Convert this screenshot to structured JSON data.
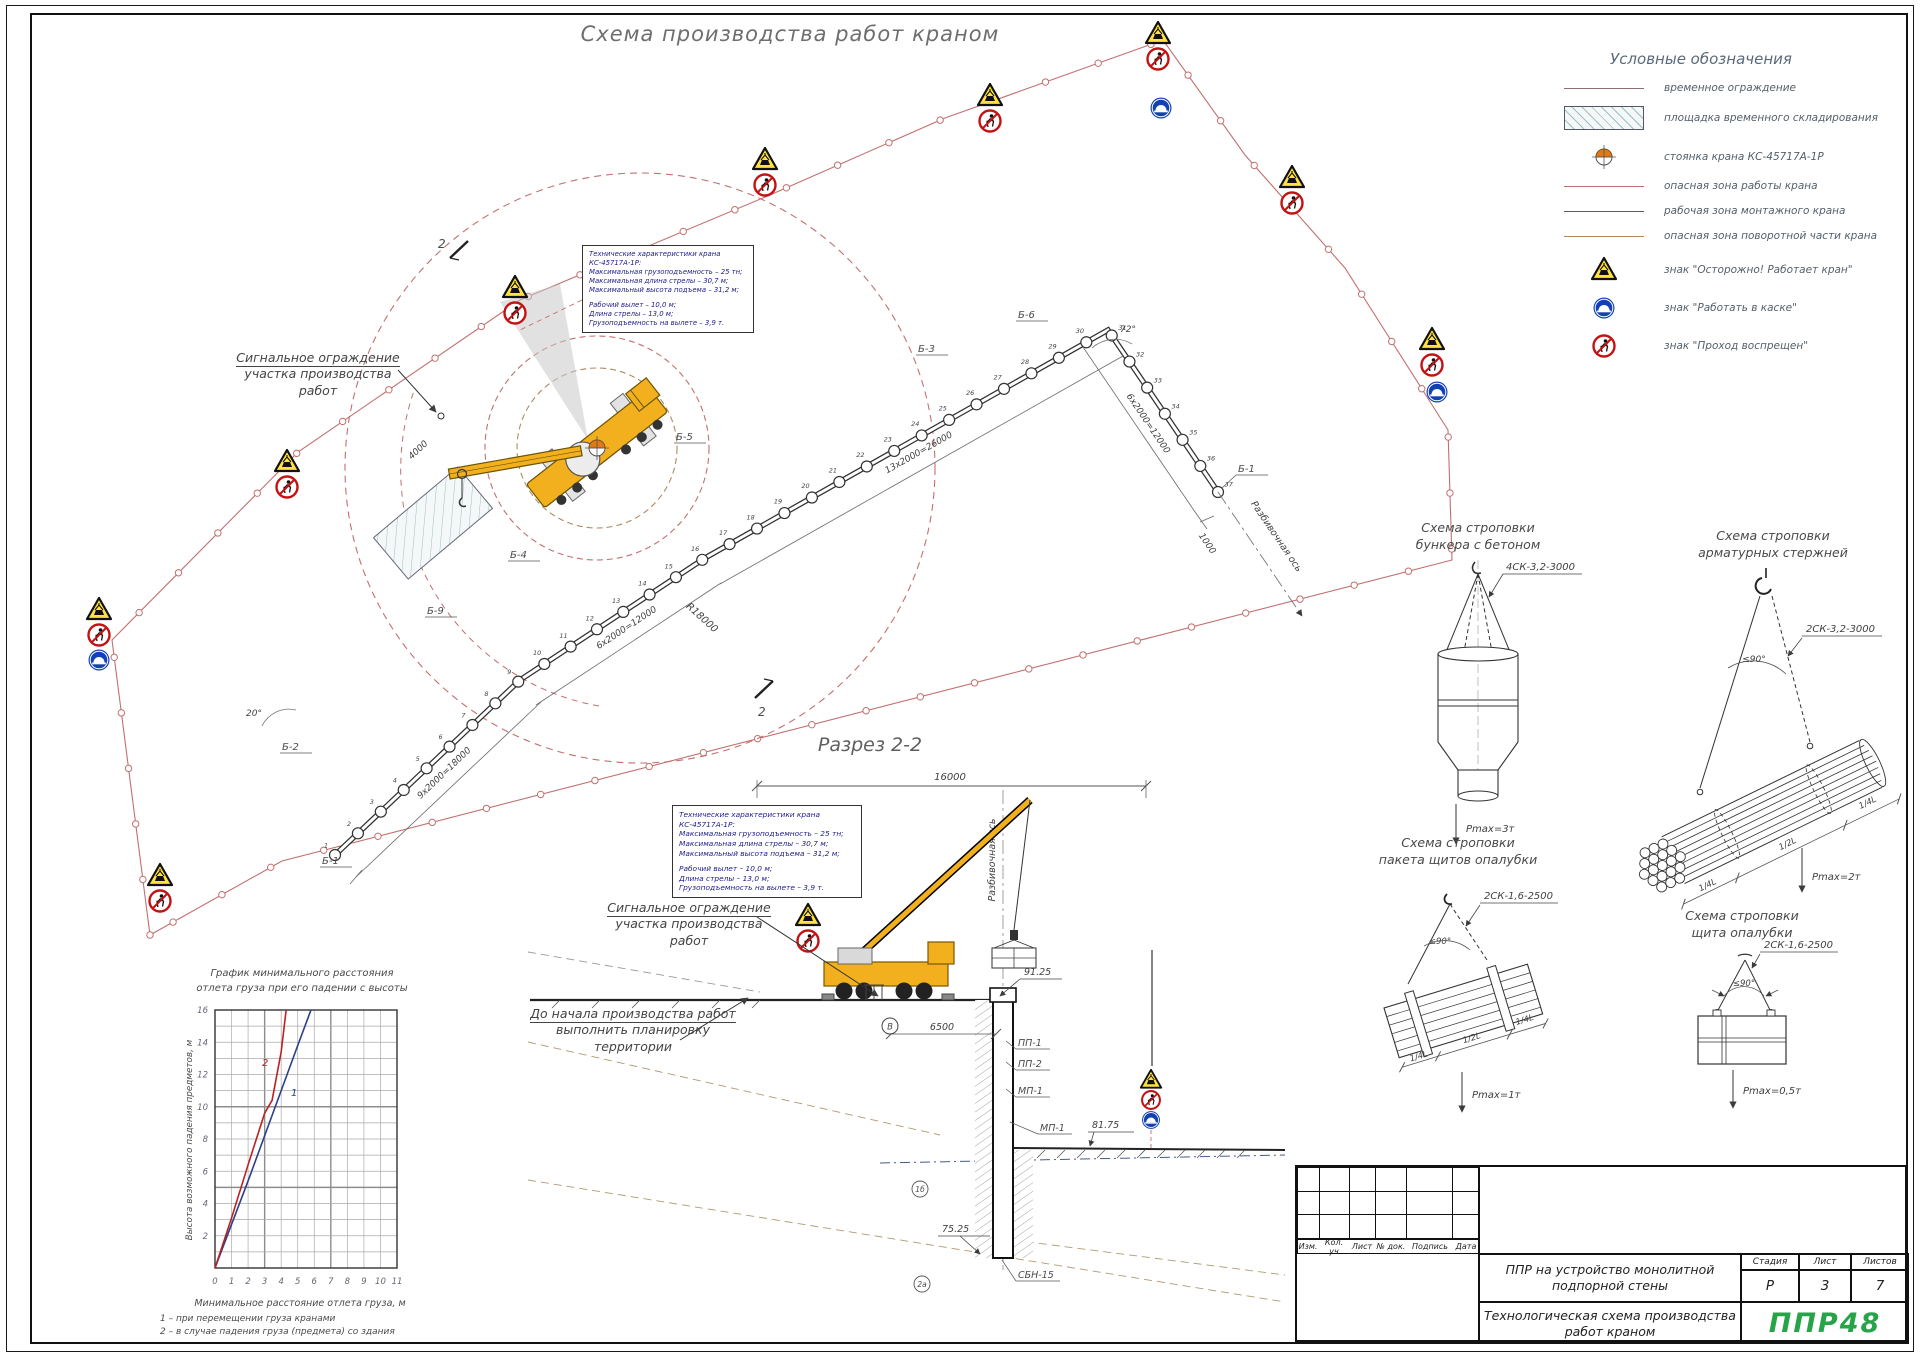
{
  "sheet": {
    "title": "Схема производства работ краном"
  },
  "legend": {
    "title": "Условные обозначения",
    "items": [
      {
        "icon": "line-plain",
        "label": "временное ограждение"
      },
      {
        "icon": "hatch-rect",
        "label": "площадка временного складирования"
      },
      {
        "icon": "crane-parking",
        "label": "стоянка крана КС-45717А-1Р"
      },
      {
        "icon": "line-red",
        "label": "опасная зона работы крана"
      },
      {
        "icon": "line-dark",
        "label": "рабочая зона монтажного крана"
      },
      {
        "icon": "line-brown",
        "label": "опасная зона поворотной части крана"
      },
      {
        "icon": "sign-warning",
        "label": "знак \"Осторожно! Работает кран\""
      },
      {
        "icon": "sign-helmet",
        "label": "знак \"Работать в каске\""
      },
      {
        "icon": "sign-no-entry",
        "label": "знак \"Проход воспрещен\""
      }
    ]
  },
  "crane_specs": {
    "title": "Технические характеристики крана КС-45717А-1Р:",
    "lines1": [
      "Максимальная грузоподъемность – 25 тн;",
      "Максимальная длина стрелы – 30,7 м;",
      "Максимальный высота подъема – 31,2 м;"
    ],
    "lines2": [
      "Рабочий вылет – 10,0 м;",
      "Длина стрелы – 13,0 м;",
      "Грузоподъемность на вылете – 3,9 т."
    ]
  },
  "plan": {
    "callout1": "Сигнальное ограждение",
    "callout2": "участка производства работ",
    "dim_top": "13х2000=26000",
    "dim_mid": "6х2000=12000",
    "dim_low": "9х2000=18000",
    "dim_right": "6х2000=12000",
    "dim_1000": "1000",
    "dim_4000": "4000",
    "radius_label": "R18000",
    "angle_left": "20°",
    "angle_right": "72°",
    "axis_label": "Разбивочная ось",
    "cut_label": "2",
    "marks": {
      "b1": "Б-1",
      "b2": "Б-2",
      "b3": "Б-3",
      "b4": "Б-4",
      "b5": "Б-5",
      "b6": "Б-6",
      "b9": "Б-9",
      "b1r": "Б-1"
    },
    "pile_count": 37
  },
  "section": {
    "title": "Разрез 2-2",
    "callout1": "Сигнальное ограждение",
    "callout2": "участка производства работ",
    "note1": "До начала производства работ",
    "note2": "выполнить планировку территории",
    "axis_label": "Разбивочная ось",
    "dim_width": "16000",
    "dim_offset": "6500",
    "elev_top": "91.25",
    "elev_mid": "81.75",
    "elev_low": "75.25",
    "lbl_pp1": "ПП-1",
    "lbl_pp2": "ПП-2",
    "lbl_mp1": "МП-1",
    "lbl_mp1b": "МП-1",
    "lbl_pile": "СБН-15",
    "axis_mark": "В",
    "soil1": "1б",
    "soil2": "2а"
  },
  "rigging": {
    "s1": {
      "t1": "Схема строповки",
      "t2": "бункера с бетоном",
      "sling": "4СК-3,2-3000",
      "pmax": "Pmax=3т"
    },
    "s2": {
      "t1": "Схема строповки",
      "t2": "арматурных стержней",
      "sling": "2СК-3,2-3000",
      "angle": "≤90°",
      "pmax": "Pmax=2т",
      "f1": "1/4L",
      "f2": "1/2L",
      "f3": "1/4L"
    },
    "s3": {
      "t1": "Схема строповки",
      "t2": "пакета щитов опалубки",
      "sling": "2СК-1,6-2500",
      "angle": "≤90°",
      "pmax": "Pmax=1т",
      "f1": "1/4L",
      "f2": "1/2L",
      "f3": "1/4L"
    },
    "s4": {
      "t1": "Схема строповки",
      "t2": "щита  опалубки",
      "sling": "2СК-1,6-2500",
      "angle": "≤90°",
      "pmax": "Pmax=0,5т"
    }
  },
  "chart_data": {
    "type": "line",
    "title": "График минимального расстояния отлета груза при его падении с высоты",
    "title_lines": [
      "График минимального расстояния",
      "отлета груза при его падении с высоты"
    ],
    "xlabel": "Минимальное расстояние отлета груза, м",
    "ylabel": "Высота возможного падения предметов, м",
    "xlim": [
      0,
      11
    ],
    "ylim": [
      0,
      16
    ],
    "x_ticks": [
      0,
      1,
      2,
      3,
      4,
      5,
      6,
      7,
      8,
      9,
      10,
      11
    ],
    "y_ticks": [
      2,
      4,
      6,
      8,
      10,
      12,
      14,
      16
    ],
    "grid": true,
    "legend_position": "none",
    "series": [
      {
        "name": "1",
        "color": "#2b3f8c",
        "points": [
          [
            0,
            0
          ],
          [
            1,
            2.7
          ],
          [
            2,
            5.4
          ],
          [
            3,
            8.2
          ],
          [
            4,
            11
          ],
          [
            5,
            13.8
          ],
          [
            5.8,
            16
          ]
        ]
      },
      {
        "name": "2",
        "color": "#b92222",
        "points": [
          [
            0,
            0
          ],
          [
            1,
            3.1
          ],
          [
            2,
            6.4
          ],
          [
            3,
            9.6
          ],
          [
            3.45,
            10.4
          ],
          [
            4,
            13.4
          ],
          [
            4.3,
            16
          ]
        ]
      }
    ],
    "notes": [
      "1 – при перемещении груза кранами",
      "2 – в случае падения груза (предмета) со здания"
    ]
  },
  "titleblock": {
    "rev_cols": [
      "Изм.",
      "Кол. уч",
      "Лист",
      "№ док.",
      "Подпись",
      "Дата"
    ],
    "project_lines": [
      "ППР на устройство монолитной",
      "подпорной стены"
    ],
    "drawing_lines": [
      "Технологическая схема производства",
      "работ краном"
    ],
    "stage_label": "Стадия",
    "sheet_label": "Лист",
    "sheets_label": "Листов",
    "stage": "Р",
    "sheet": "3",
    "sheets": "7",
    "logo": "ППР48"
  },
  "colors": {
    "danger_red": "#c2706f",
    "work_zone": "#5a5a6e",
    "slew_zone": "#b08a62",
    "crane_yellow": "#f2b01e",
    "sign_blue": "#1241b5",
    "sign_red": "#c41111",
    "warn_yellow": "#ffe23c",
    "spec_navy": "#1c1c8a",
    "logo_green": "#27a348"
  }
}
